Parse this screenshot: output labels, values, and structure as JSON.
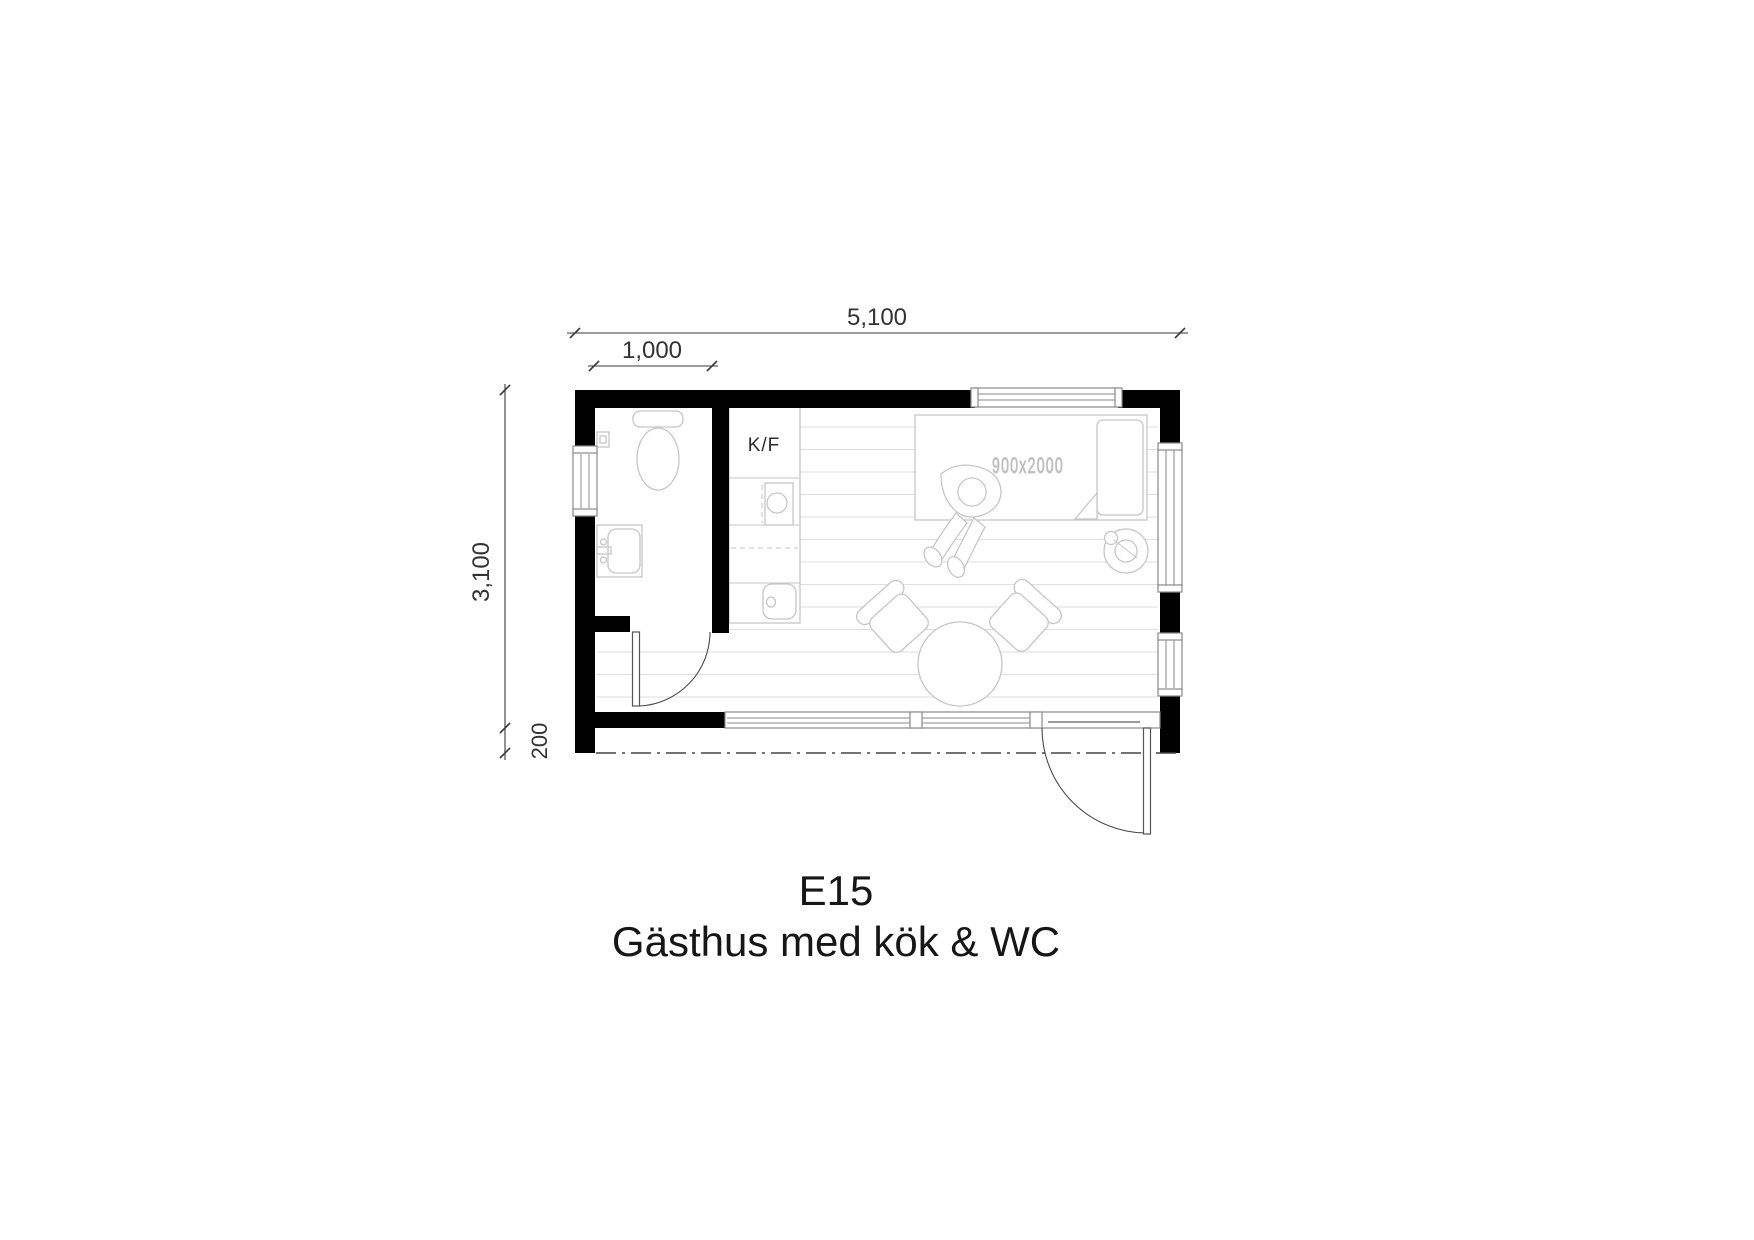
{
  "document": {
    "kind": "architectural floor plan drawing",
    "background": "#ffffff"
  },
  "title": {
    "code": "E15",
    "subtitle": "Gästhus med kök & WC"
  },
  "dimensions": {
    "overall_width": "5,100",
    "bathroom_width": "1,000",
    "overall_depth": "3,100",
    "eave_offset": "200"
  },
  "labels": {
    "fridge_freezer": "K/F",
    "bed_size": "900x2000"
  },
  "colors": {
    "walls": "#000000",
    "furniture": "#c6c6c6",
    "floorboard": "#dedede",
    "dimension": "#3a3a3a",
    "bed_label": "#b8b8b8",
    "title_text": "#161616"
  }
}
